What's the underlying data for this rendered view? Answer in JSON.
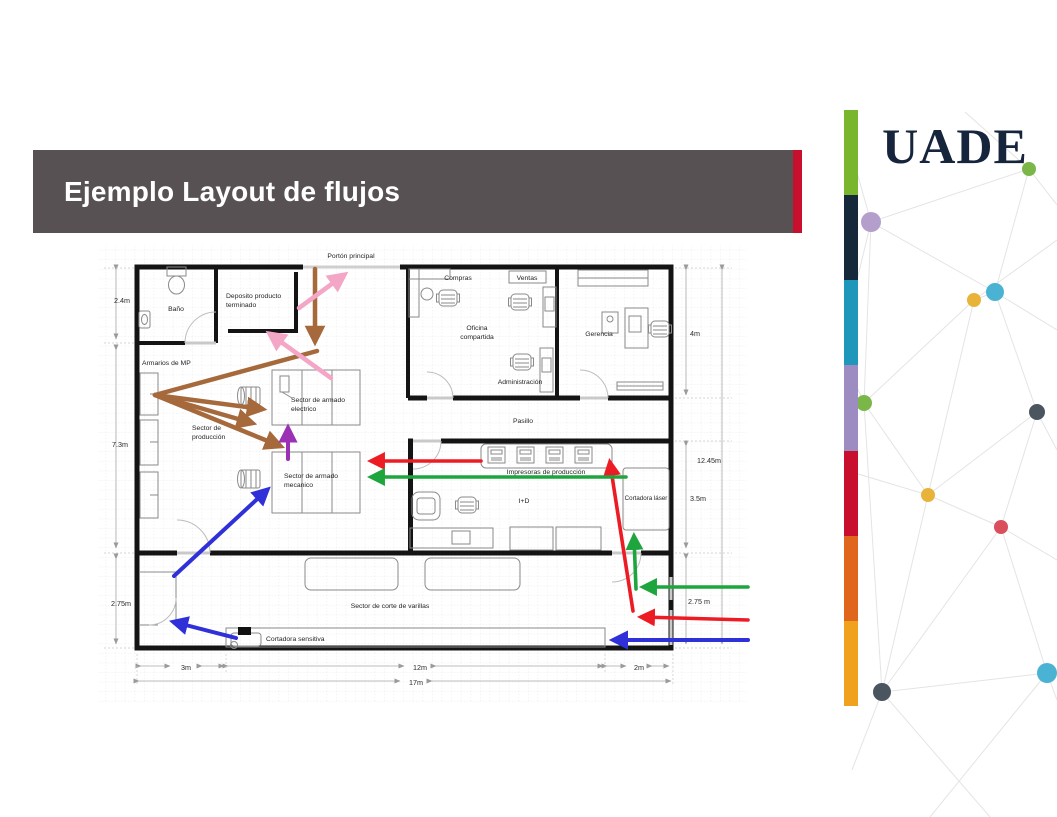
{
  "slide": {
    "title": "Ejemplo Layout de flujos"
  },
  "brand": {
    "logo_text": "UADE",
    "stripe_colors": [
      "#79b62d",
      "#16293b",
      "#1f97ba",
      "#9d8cc2",
      "#c8102e",
      "#e0661d",
      "#f0a11d"
    ]
  },
  "colors": {
    "banner_bg": "#575153",
    "banner_accent": "#c8102e",
    "logo_color": "#16243c",
    "wall": "#141414",
    "furniture": "#8a8a8a",
    "porton_line": "#cfcfcf",
    "flow_brown": "#a5693c",
    "flow_pink": "#f4a6c6",
    "flow_purple": "#9b30b4",
    "flow_red": "#ed1c24",
    "flow_green": "#1fa53d",
    "flow_blue": "#3030d9",
    "network_line": "#e4e4e4",
    "dim_color": "#a8a8a8"
  },
  "network_dots": {
    "green": "#7ab648",
    "purple": "#b49fcc",
    "cyan": "#4ab3d4",
    "yellow": "#e8b339",
    "slate": "#4a5560",
    "red": "#d94f5c"
  },
  "plan": {
    "labels": {
      "porton": "Portón principal",
      "bano": "Baño",
      "deposito_l1": "Deposito producto",
      "deposito_l2": "terminado",
      "armarios": "Armarios de MP",
      "compras": "Compras",
      "ventas": "Ventas",
      "oficina_l1": "Oficina",
      "oficina_l2": "compartida",
      "administracion": "Administración",
      "gerencia": "Gerencia",
      "pasillo": "Pasillo",
      "impresoras": "Impresoras de producción",
      "id": "I+D",
      "cortadora_laser": "Cortadora láser",
      "sector_prod_l1": "Sector de",
      "sector_prod_l2": "producción",
      "armado_elec_l1": "Sector de armado",
      "armado_elec_l2": "electrico",
      "armado_mec_l1": "Sector de armado",
      "armado_mec_l2": "mecanico",
      "corte_varillas": "Sector de corte de varillas",
      "cortadora_sensitiva": "Cortadora sensitiva"
    },
    "dimensions": {
      "h_bano": "2.4m",
      "h_produccion": "7.3m",
      "h_corte_left": "2.75m",
      "h_oficinas": "4m",
      "h_total_right": "12.45m",
      "h_impresoras": "3.5m",
      "h_corte_right": "2.75 m",
      "w_left": "3m",
      "w_mid": "12m",
      "w_right": "2m",
      "w_total": "17m"
    }
  }
}
